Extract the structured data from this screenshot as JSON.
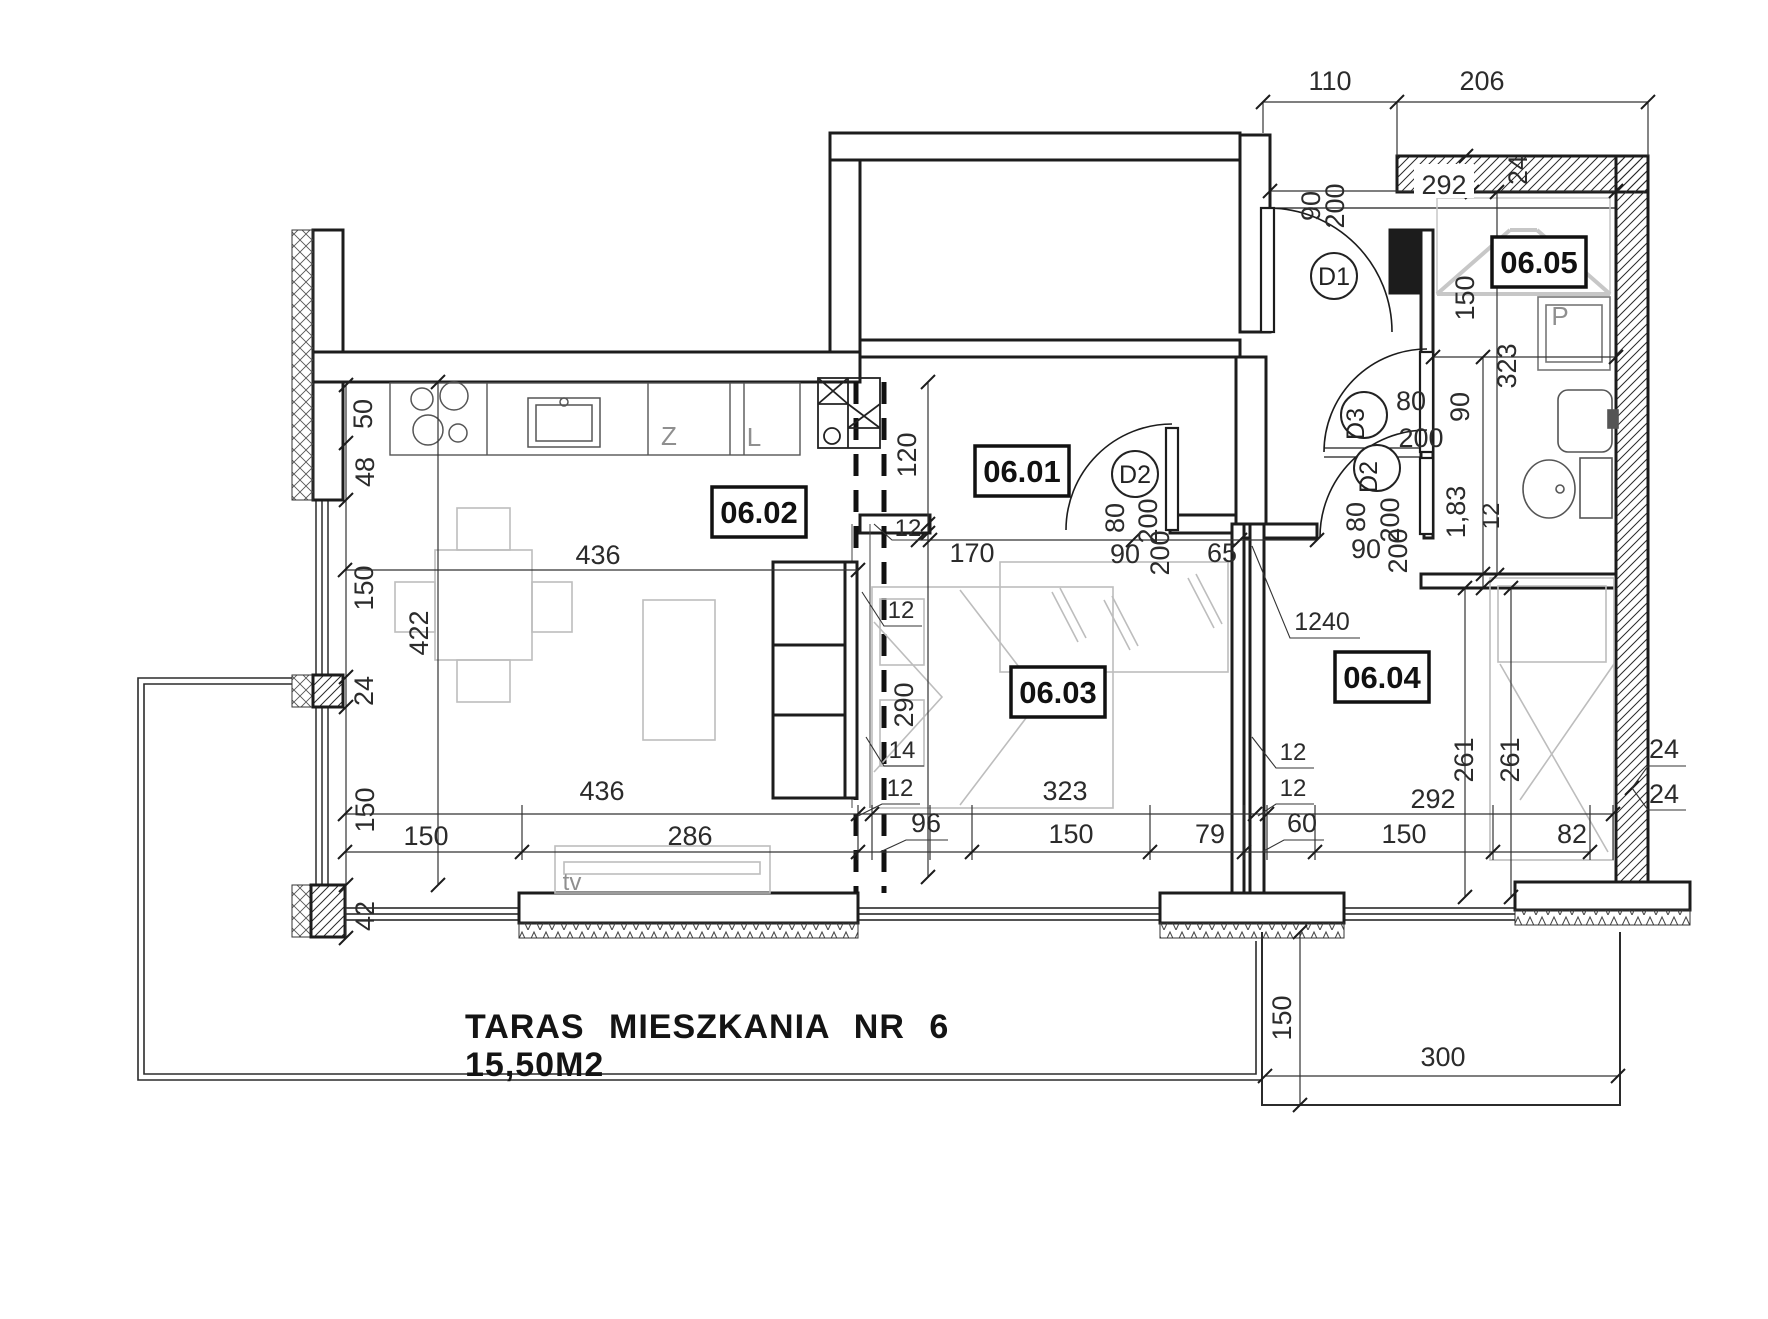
{
  "title": {
    "line1": "TARAS MIESZKANIA NR 6",
    "line2": "15,50M2"
  },
  "rooms": [
    {
      "id": "06.01",
      "x": 1022,
      "y": 471
    },
    {
      "id": "06.02",
      "x": 759,
      "y": 512
    },
    {
      "id": "06.03",
      "x": 1058,
      "y": 692
    },
    {
      "id": "06.04",
      "x": 1382,
      "y": 677
    },
    {
      "id": "06.05",
      "x": 1539,
      "y": 262
    }
  ],
  "doors": [
    {
      "tag": "D1",
      "x": 1334,
      "y": 276,
      "r": 0,
      "leaf": "90/200"
    },
    {
      "tag": "D2",
      "x": 1135,
      "y": 474,
      "r": 0,
      "leaf": "80/200"
    },
    {
      "tag": "D3",
      "x": 1364,
      "y": 415,
      "r": -90,
      "leaf": "80/200"
    },
    {
      "tag": "D2",
      "x": 1377,
      "y": 468,
      "r": -90,
      "leaf": "80/200"
    }
  ],
  "dims": [
    {
      "t": "110",
      "x": 1330,
      "y": 90
    },
    {
      "t": "206",
      "x": 1482,
      "y": 90
    },
    {
      "t": "292",
      "x": 1444,
      "y": 194
    },
    {
      "t": "24",
      "x": 1527,
      "y": 170,
      "r": -90
    },
    {
      "t": "90",
      "x": 1320,
      "y": 206,
      "r": -90
    },
    {
      "t": "200",
      "x": 1344,
      "y": 206,
      "r": -90
    },
    {
      "t": "150",
      "x": 1474,
      "y": 298,
      "r": -90
    },
    {
      "t": "323",
      "x": 1516,
      "y": 366,
      "r": -90
    },
    {
      "t": "1,83",
      "x": 1465,
      "y": 512,
      "r": -90
    },
    {
      "t": "12",
      "x": 1499,
      "y": 516,
      "r": -90,
      "s": 24
    },
    {
      "t": "80",
      "x": 1411,
      "y": 410
    },
    {
      "t": "200",
      "x": 1421,
      "y": 447
    },
    {
      "t": "90",
      "x": 1469,
      "y": 407,
      "r": -90
    },
    {
      "t": "120",
      "x": 916,
      "y": 455,
      "r": -90
    },
    {
      "t": "12",
      "x": 908,
      "y": 536,
      "s": 24
    },
    {
      "t": "170",
      "x": 972,
      "y": 562
    },
    {
      "t": "80",
      "x": 1124,
      "y": 518,
      "r": -90
    },
    {
      "t": "200",
      "x": 1157,
      "y": 521,
      "r": -90
    },
    {
      "t": "90",
      "x": 1125,
      "y": 563
    },
    {
      "t": "200",
      "x": 1169,
      "y": 553,
      "r": -90
    },
    {
      "t": "65",
      "x": 1222,
      "y": 562
    },
    {
      "t": "80",
      "x": 1365,
      "y": 517,
      "r": -90
    },
    {
      "t": "200",
      "x": 1399,
      "y": 520,
      "r": -90
    },
    {
      "t": "90",
      "x": 1366,
      "y": 558
    },
    {
      "t": "200",
      "x": 1407,
      "y": 551,
      "r": -90
    },
    {
      "t": "1240",
      "x": 1322,
      "y": 630,
      "s": 25
    },
    {
      "t": "290",
      "x": 913,
      "y": 705,
      "r": -90
    },
    {
      "t": "12",
      "x": 901,
      "y": 618,
      "s": 24
    },
    {
      "t": "14",
      "x": 902,
      "y": 758,
      "s": 24
    },
    {
      "t": "12",
      "x": 900,
      "y": 796,
      "s": 24
    },
    {
      "t": "96",
      "x": 926,
      "y": 832
    },
    {
      "t": "12",
      "x": 1293,
      "y": 760,
      "s": 24
    },
    {
      "t": "12",
      "x": 1293,
      "y": 796,
      "s": 24
    },
    {
      "t": "60",
      "x": 1302,
      "y": 832
    },
    {
      "t": "436",
      "x": 598,
      "y": 564
    },
    {
      "t": "422",
      "x": 428,
      "y": 633,
      "r": -90
    },
    {
      "t": "436",
      "x": 602,
      "y": 800
    },
    {
      "t": "323",
      "x": 1065,
      "y": 800
    },
    {
      "t": "292",
      "x": 1433,
      "y": 808
    },
    {
      "t": "261",
      "x": 1473,
      "y": 760,
      "r": -90
    },
    {
      "t": "261",
      "x": 1519,
      "y": 760,
      "r": -90
    },
    {
      "t": "150",
      "x": 426,
      "y": 845
    },
    {
      "t": "286",
      "x": 690,
      "y": 845
    },
    {
      "t": "150",
      "x": 1071,
      "y": 843
    },
    {
      "t": "79",
      "x": 1210,
      "y": 843
    },
    {
      "t": "150",
      "x": 1404,
      "y": 843
    },
    {
      "t": "82",
      "x": 1572,
      "y": 843
    },
    {
      "t": "24",
      "x": 1664,
      "y": 758
    },
    {
      "t": "24",
      "x": 1664,
      "y": 803
    },
    {
      "t": "50",
      "x": 372,
      "y": 414,
      "r": -90
    },
    {
      "t": "48",
      "x": 374,
      "y": 472,
      "r": -90
    },
    {
      "t": "150",
      "x": 373,
      "y": 588,
      "r": -90
    },
    {
      "t": "24",
      "x": 373,
      "y": 691,
      "r": -90
    },
    {
      "t": "150",
      "x": 374,
      "y": 810,
      "r": -90
    },
    {
      "t": "42",
      "x": 374,
      "y": 916,
      "r": -90
    },
    {
      "t": "150",
      "x": 1291,
      "y": 1018,
      "r": -90
    },
    {
      "t": "300",
      "x": 1443,
      "y": 1066
    }
  ],
  "furniture_labels": [
    {
      "t": "Z",
      "x": 669,
      "y": 445
    },
    {
      "t": "L",
      "x": 754,
      "y": 446
    },
    {
      "t": "tv",
      "x": 572,
      "y": 890,
      "s": 24
    },
    {
      "t": "P",
      "x": 1560,
      "y": 325
    }
  ]
}
